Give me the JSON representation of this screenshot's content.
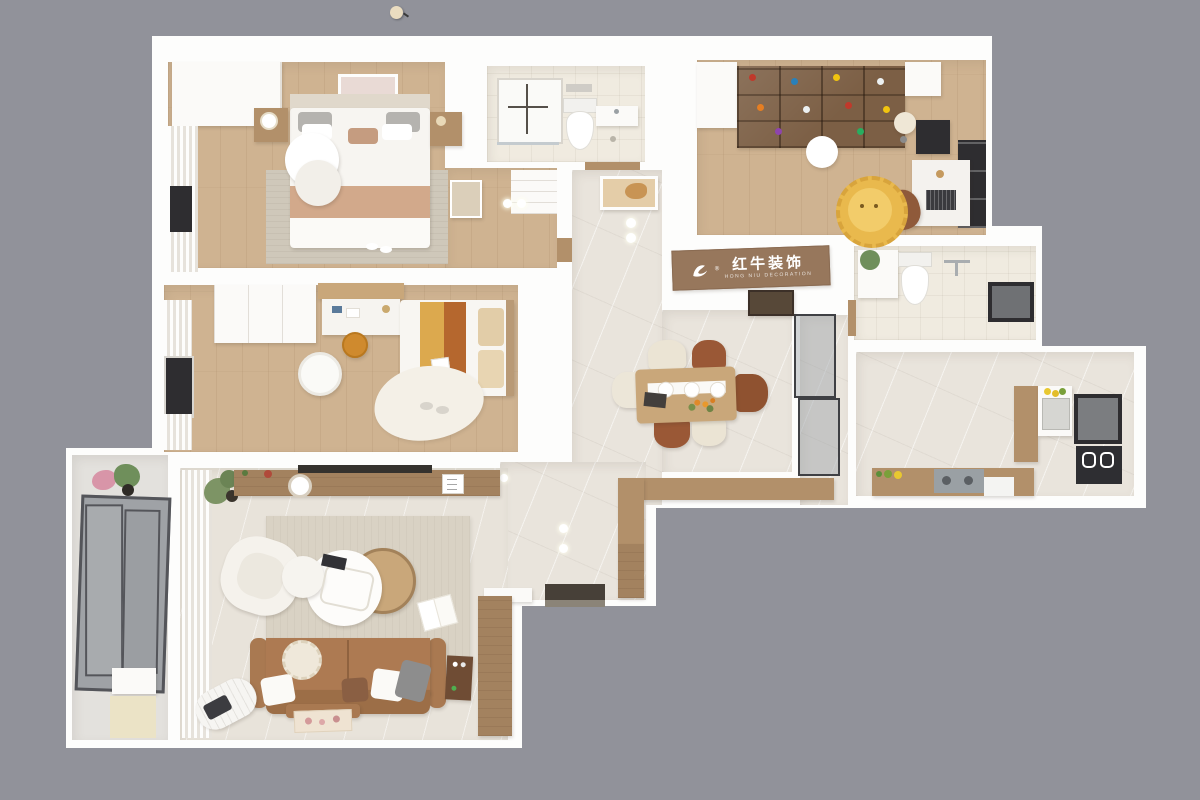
{
  "scene": {
    "type": "3d-top-down-floor-plan-render",
    "description": "Bird's-eye 3D render of a furnished apartment on a gray backdrop"
  },
  "sign": {
    "brand_cn": "红牛装饰",
    "brand_en": "HONG NIU DECORATION",
    "reg": "®"
  },
  "palette": {
    "bg": "#91929a",
    "wall": "#fdfdfc",
    "wood": "#cfb391",
    "marble": "#e9e4dc",
    "tile": "#f0ebe0",
    "living": "#e8e3da",
    "balconyglass": "#9fa2a6",
    "woodfurn": "#b2906a",
    "wood2": "#c9a77a",
    "wood3": "#a3825f",
    "shelfwood": "#7c5f45",
    "dark": "#2e2d30",
    "sofa": "#ad7a52",
    "rug": "#cfc8ba",
    "ruglv": "#d9d2c4",
    "cream": "#ebe4d4",
    "rust": "#9a5836",
    "mustard": "#dca94e",
    "rustbed": "#b5672e",
    "lion": "#e9b94d",
    "green": "#6f8f5b",
    "sign": "#97775c",
    "doormat": "#474038"
  },
  "floorplan": {
    "rooms": [
      {
        "name": "master-bedroom",
        "floor": "wood",
        "furniture": [
          "double-bed",
          "gray-pillows",
          "tan-blanket",
          "wardrobe",
          "sheer-curtain",
          "tv-niche",
          "wall-art",
          "nightstand-left",
          "nightstand-right",
          "round-side-tables",
          "area-rug",
          "slippers",
          "leaning-mirror",
          "closet-shelves",
          "ceiling-lights"
        ]
      },
      {
        "name": "bathroom-top",
        "floor": "tile",
        "furniture": [
          "shower-tray",
          "toilet",
          "vanity",
          "floor-drain"
        ]
      },
      {
        "name": "study",
        "floor": "wood",
        "furniture": [
          "toy-display-shelf",
          "white-cabinets",
          "round-pendant-lamp",
          "floor-lamp",
          "desk",
          "laptop",
          "monitor",
          "desk-chair",
          "lion-rug",
          "dark-window"
        ]
      },
      {
        "name": "bathroom-right",
        "floor": "tile",
        "furniture": [
          "vanity-with-plant",
          "toilet",
          "shower-arm",
          "window"
        ]
      },
      {
        "name": "kitchen",
        "floor": "marble",
        "furniture": [
          "pantry-cabinet",
          "sink-counter",
          "lemons",
          "window",
          "oven-stack",
          "lower-counter",
          "cooktop",
          "fruit-bowl",
          "dishwasher"
        ]
      },
      {
        "name": "dining-area",
        "floor": "marble",
        "furniture": [
          "dining-table",
          "table-runner",
          "plates",
          "flowers",
          "book",
          "cream-chairs",
          "brown-chairs",
          "rust-armchair",
          "glass-partition",
          "sideboard",
          "brand-sign",
          "hall-art",
          "ceiling-lights"
        ]
      },
      {
        "name": "hallway",
        "floor": "marble",
        "furniture": [
          "wall-art",
          "ceiling-lights"
        ]
      },
      {
        "name": "entry",
        "floor": "marble",
        "furniture": [
          "shoe-cabinet",
          "tall-cabinet",
          "console",
          "door-mat",
          "entry-door",
          "ceiling-lights"
        ]
      },
      {
        "name": "living-room",
        "floor": "light-stone",
        "furniture": [
          "tv-console",
          "wall-tv",
          "clock",
          "plant",
          "area-rug",
          "white-armchair",
          "wood-coffee-table",
          "white-nesting-tables",
          "remote",
          "open-book",
          "brown-sofa",
          "throw-pillows",
          "radio",
          "rolled-mat",
          "floor-poster",
          "sheer-curtain"
        ]
      },
      {
        "name": "second-bedroom",
        "floor": "wood",
        "furniture": [
          "single-bed",
          "striped-bedding",
          "headboard",
          "wardrobe",
          "desk-with-shelf",
          "orange-stool",
          "round-pouf",
          "blob-rug",
          "slippers",
          "curtain-window"
        ]
      },
      {
        "name": "balcony",
        "floor": "stone",
        "furniture": [
          "flower-pots",
          "glazed-windows",
          "cream-mat",
          "white-appliance"
        ]
      }
    ],
    "exterior": [
      "gray-backdrop",
      "small-pendant-light-top"
    ]
  }
}
